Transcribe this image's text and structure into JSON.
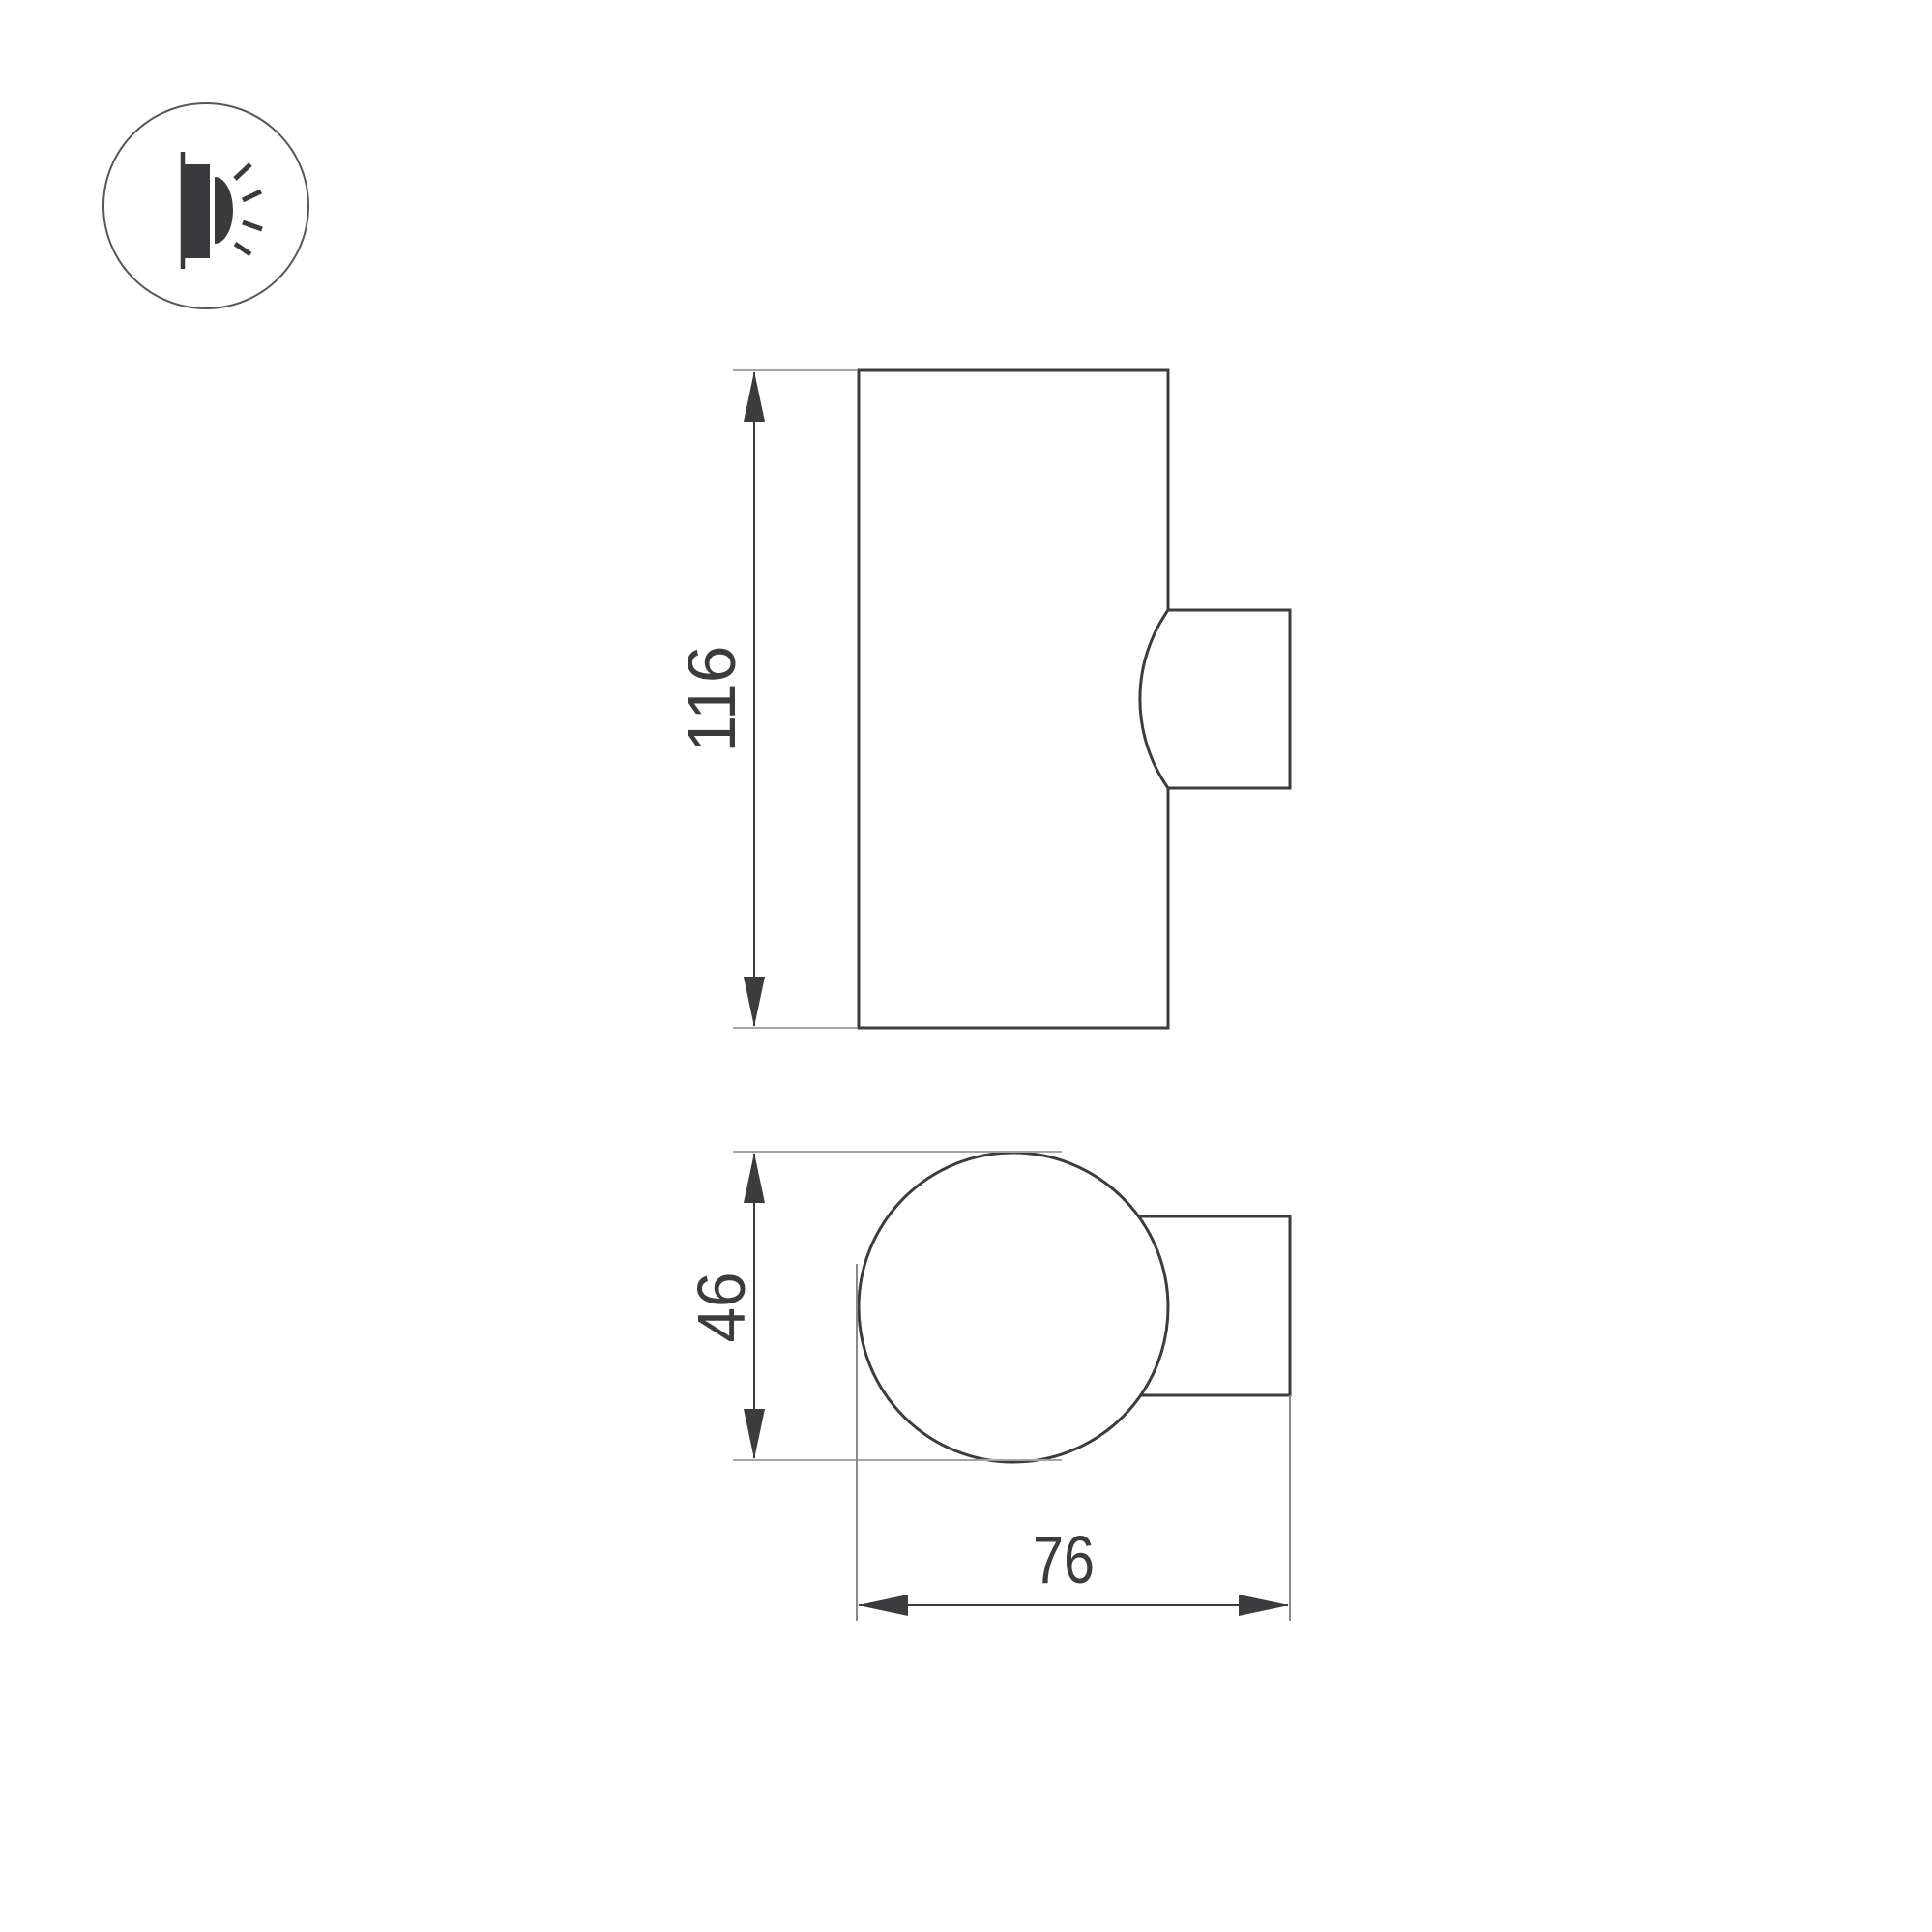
{
  "drawing": {
    "front_view": {
      "height_label": "116"
    },
    "top_view": {
      "diameter_label": "46",
      "depth_label": "76"
    }
  },
  "icons": {
    "badge": "wall-light-side-glow-icon"
  },
  "colors": {
    "line": "#3c3c3f",
    "extension_line": "#a5a5a8",
    "text": "#3c3c3f",
    "icon": "#3a3a3d",
    "badge_outline": "#57575b",
    "background": "#ffffff"
  }
}
